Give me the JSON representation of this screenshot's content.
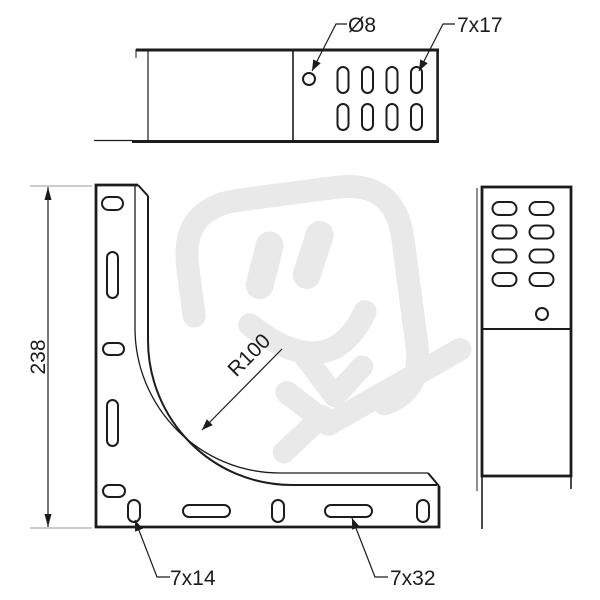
{
  "drawing": {
    "kind": "technical-drawing-cable-tray-90-degree-bend",
    "labels": {
      "hole_dia": "Ø8",
      "slot_top": "7x17",
      "overall_height": "238",
      "bend_radius": "R100",
      "slot_bottom_small": "7x14",
      "slot_bottom_long": "7x32"
    },
    "views": {
      "top": {
        "slot_count": 8,
        "round_hole_count": 1
      },
      "front": {
        "left_flange_slot_count": 5,
        "bottom_flange_slot_count": 5
      },
      "side": {
        "slot_count": 8,
        "round_hole_count": 1
      }
    },
    "colors": {
      "background": "#ffffff",
      "line": "#1c1c1c",
      "extension_line": "#9a9a9a",
      "watermark": "#e9e9e9"
    }
  }
}
